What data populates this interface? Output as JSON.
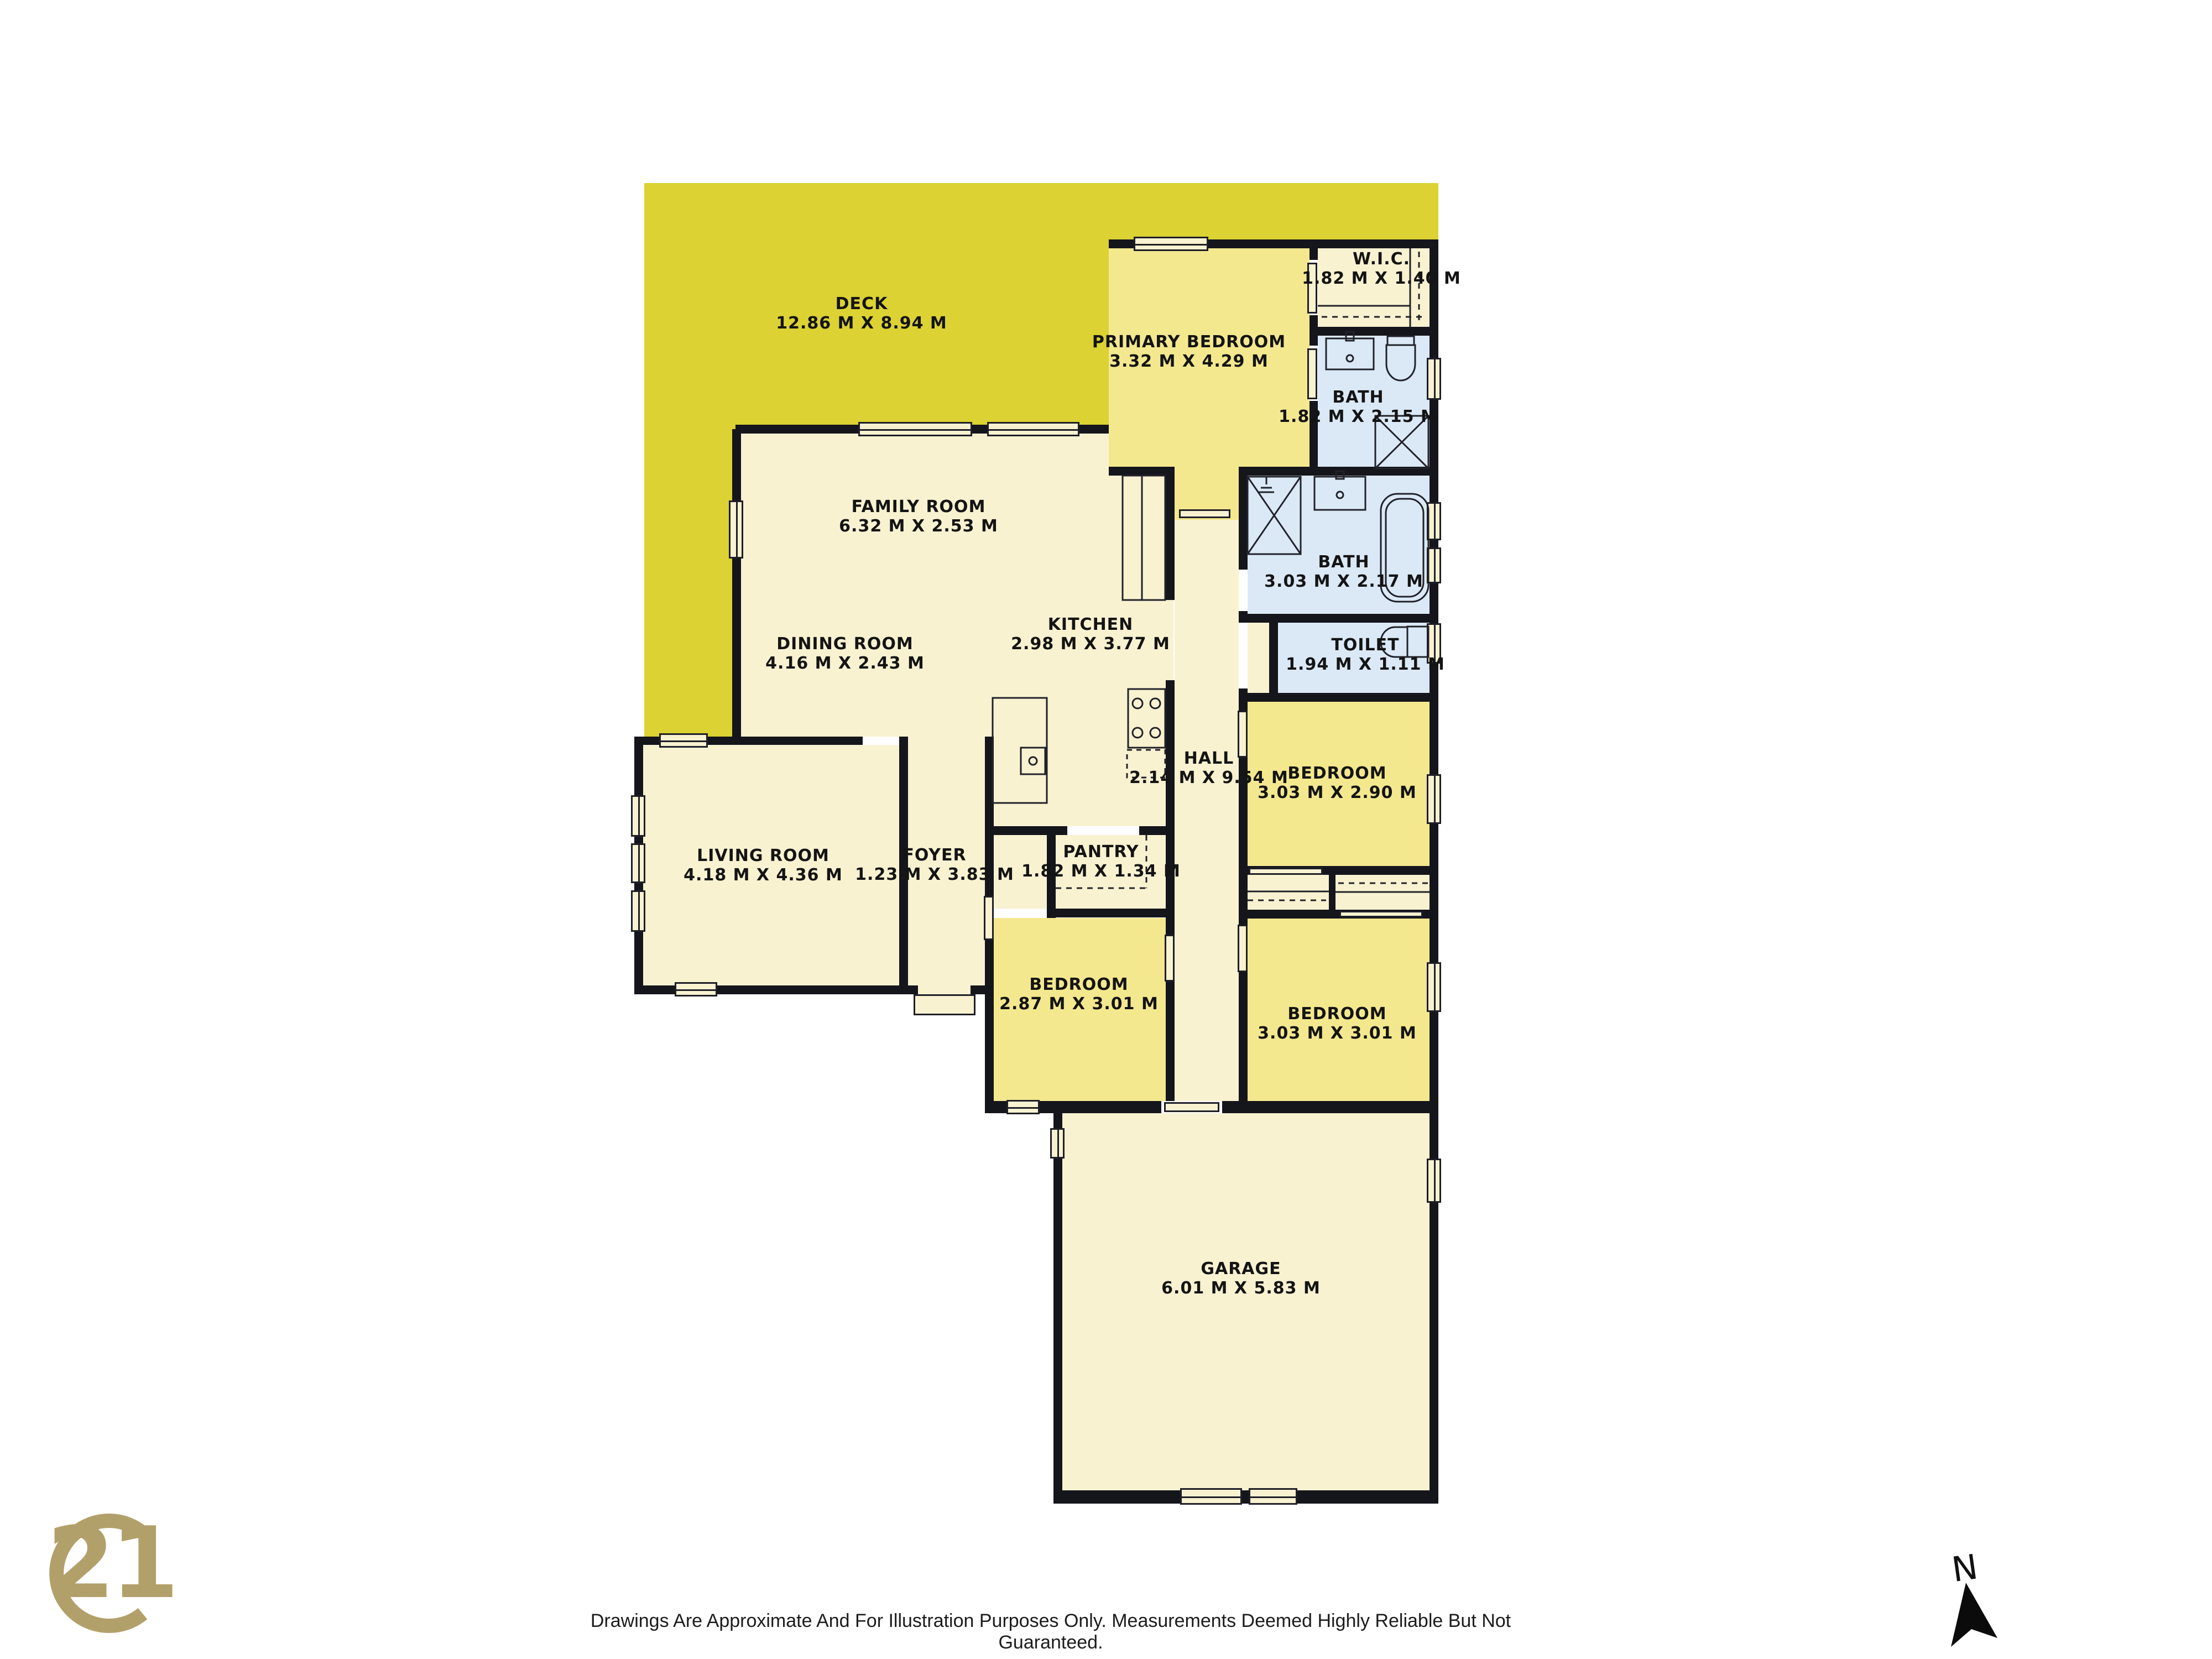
{
  "rooms": [
    {
      "name": "DECK",
      "dims": "12.86 M X 8.94 M"
    },
    {
      "name": "PRIMARY BEDROOM",
      "dims": "3.32 M X 4.29 M"
    },
    {
      "name": "W.I.C.",
      "dims": "1.82 M X 1.40 M"
    },
    {
      "name": "BATH",
      "dims": "1.82 M X 2.15 M"
    },
    {
      "name": "FAMILY ROOM",
      "dims": "6.32 M X 2.53 M"
    },
    {
      "name": "DINING ROOM",
      "dims": "4.16 M X 2.43 M"
    },
    {
      "name": "KITCHEN",
      "dims": "2.98 M X 3.77 M"
    },
    {
      "name": "BATH",
      "dims": "3.03 M X 2.17 M"
    },
    {
      "name": "TOILET",
      "dims": "1.94 M X 1.11 M"
    },
    {
      "name": "HALL",
      "dims": "2.14 M X 9.54 M"
    },
    {
      "name": "BEDROOM",
      "dims": "3.03 M X 2.90 M"
    },
    {
      "name": "LIVING ROOM",
      "dims": "4.18 M X 4.36 M"
    },
    {
      "name": "FOYER",
      "dims": "1.23 M X 3.83 M"
    },
    {
      "name": "PANTRY",
      "dims": "1.82 M X 1.34 M"
    },
    {
      "name": "BEDROOM",
      "dims": "2.87 M X 3.01 M"
    },
    {
      "name": "BEDROOM",
      "dims": "3.03 M X 3.01 M"
    },
    {
      "name": "GARAGE",
      "dims": "6.01 M X 5.83 M"
    }
  ],
  "footer": {
    "disclaimer": "Drawings Are Approximate And For Illustration Purposes Only. Measurements Deemed Highly Reliable But Not Guaranteed."
  },
  "compass": {
    "label": "N"
  },
  "logo": {
    "number": "21",
    "service_mark": "SM"
  },
  "colors": {
    "deck": "#dcd233",
    "floor": "#f8f2d1",
    "bedroom": "#f4e88f",
    "bath": "#dbe9f7",
    "wall": "#15151c",
    "logo_gold": "#b2a06a"
  }
}
